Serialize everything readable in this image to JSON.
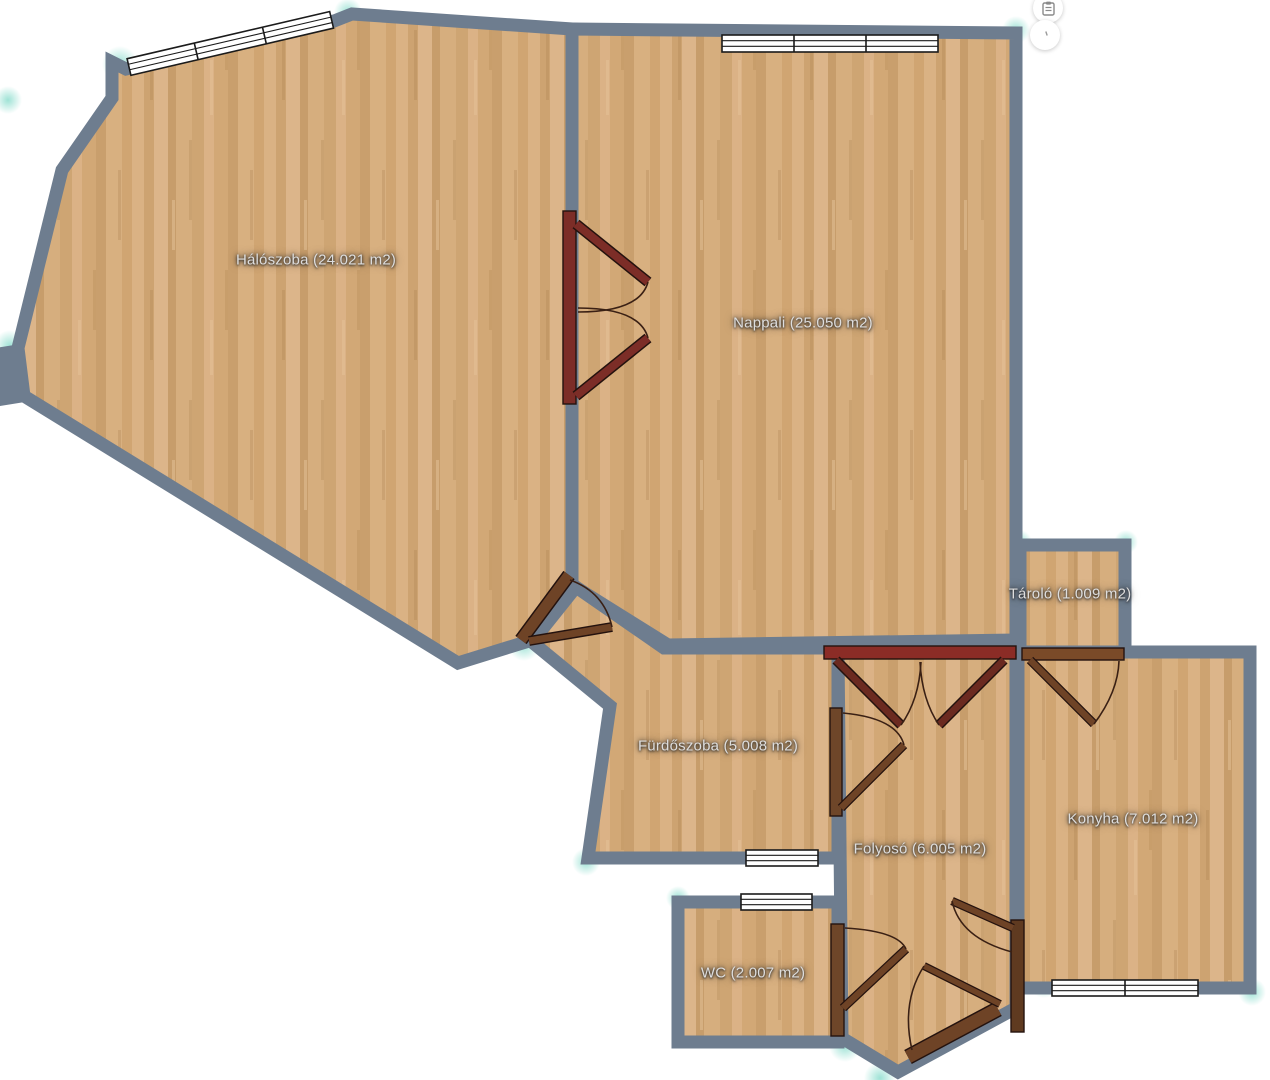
{
  "floorplan": {
    "rooms": [
      {
        "name": "Hálószoba",
        "area_m2": "24.021",
        "label": "Hálószoba (24.021 m2)"
      },
      {
        "name": "Nappali",
        "area_m2": "25.050",
        "label": "Nappali (25.050 m2)"
      },
      {
        "name": "Tároló",
        "area_m2": "1.009",
        "label": "Tároló (1.009 m2)"
      },
      {
        "name": "Fürdőszoba",
        "area_m2": "5.008",
        "label": "Fürdőszoba (5.008 m2)"
      },
      {
        "name": "Folyosó",
        "area_m2": "6.005",
        "label": "Folyosó (6.005 m2)"
      },
      {
        "name": "Konyha",
        "area_m2": "7.012",
        "label": "Konyha (7.012 m2)"
      },
      {
        "name": "WC",
        "area_m2": "2.007",
        "label": "WC (2.007 m2)"
      }
    ],
    "elements": {
      "windows": [
        "bedroom-slanted-window",
        "livingroom-top-window",
        "bathroom-bottom-window",
        "wc-top-window",
        "kitchen-bottom-window"
      ],
      "doors": [
        "bedroom-livingroom-double-door",
        "bedroom-passage-door",
        "hall-top-double-door",
        "storage-kitchen-door",
        "bathroom-hall-door",
        "wc-hall-door",
        "hall-kitchen-door",
        "entry-door"
      ]
    },
    "colors": {
      "wall": "#6e7d8f",
      "floor_base": "#d5ab7c",
      "door_dark_red": "#8b2c26",
      "door_maroon": "#7c2d27",
      "door_brown": "#6e4326",
      "highlight_teal": "#7fd9c8",
      "window_fill": "#ffffff",
      "label_text": "#dedede"
    }
  },
  "toolbar": {
    "buttons": [
      {
        "name": "clipboard-button",
        "icon": "clipboard-icon"
      },
      {
        "name": "secondary-button",
        "icon": "small-mark-icon"
      }
    ]
  }
}
